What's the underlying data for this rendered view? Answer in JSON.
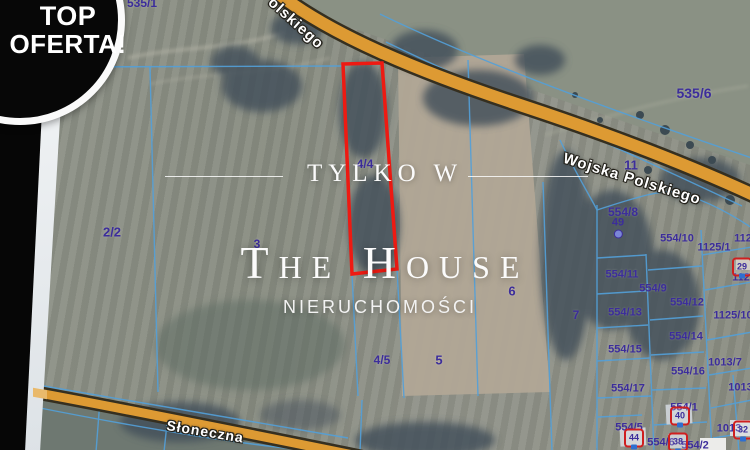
{
  "badge": {
    "line1": "TOP",
    "line2": "OFERTA!"
  },
  "overlay": {
    "tagline": "TYLKO W",
    "brand": "The House",
    "subtitle": "NIERUCHOMOŚCI"
  },
  "roads": {
    "top_label": "olskiego",
    "main_label": "Wojska Polskiego",
    "bottom_label": "Słoneczna"
  },
  "highlight_parcel_label": "4/4",
  "colors": {
    "highlight_red": "#ee1a12",
    "parcel_text": "#3c2d9b",
    "boundary_blue": "#53a0d9",
    "road_fill": "#dd9a33",
    "road_casing": "#352f20",
    "marker_red": "#cf1f1f",
    "badge_bg": "#070707",
    "overlay_text": "#fbfbfb"
  },
  "parcels": [
    {
      "t": "535/1",
      "x": 142,
      "y": 3,
      "s": 12
    },
    {
      "t": "535/6",
      "x": 694,
      "y": 93,
      "s": 14
    },
    {
      "t": "11",
      "x": 631,
      "y": 165,
      "s": 13
    },
    {
      "t": "2/2",
      "x": 112,
      "y": 232,
      "s": 13
    },
    {
      "t": "3",
      "x": 257,
      "y": 244,
      "s": 12
    },
    {
      "t": "4/4",
      "x": 365,
      "y": 164,
      "s": 12
    },
    {
      "t": "4/5",
      "x": 382,
      "y": 360,
      "s": 12
    },
    {
      "t": "5",
      "x": 439,
      "y": 360,
      "s": 13
    },
    {
      "t": "6",
      "x": 512,
      "y": 291,
      "s": 13
    },
    {
      "t": "7",
      "x": 576,
      "y": 315,
      "s": 12
    },
    {
      "t": "554/8",
      "x": 623,
      "y": 212,
      "s": 12
    },
    {
      "t": "554/10",
      "x": 677,
      "y": 239,
      "s": 11
    },
    {
      "t": "1125/1",
      "x": 714,
      "y": 248,
      "s": 11
    },
    {
      "t": "1125",
      "x": 746,
      "y": 239,
      "s": 11
    },
    {
      "t": "1125",
      "x": 744,
      "y": 278,
      "s": 11
    },
    {
      "t": "554/11",
      "x": 622,
      "y": 275,
      "s": 11
    },
    {
      "t": "554/9",
      "x": 653,
      "y": 289,
      "s": 11
    },
    {
      "t": "554/12",
      "x": 687,
      "y": 303,
      "s": 11
    },
    {
      "t": "554/13",
      "x": 625,
      "y": 313,
      "s": 11
    },
    {
      "t": "1125/10",
      "x": 733,
      "y": 316,
      "s": 11
    },
    {
      "t": "554/14",
      "x": 686,
      "y": 337,
      "s": 11
    },
    {
      "t": "554/15",
      "x": 625,
      "y": 350,
      "s": 11
    },
    {
      "t": "1013/7",
      "x": 725,
      "y": 363,
      "s": 11
    },
    {
      "t": "554/16",
      "x": 688,
      "y": 372,
      "s": 11
    },
    {
      "t": "554/17",
      "x": 628,
      "y": 389,
      "s": 11
    },
    {
      "t": "1013/",
      "x": 742,
      "y": 388,
      "s": 11
    },
    {
      "t": "554/1",
      "x": 684,
      "y": 408,
      "s": 11
    },
    {
      "t": "554/5",
      "x": 629,
      "y": 428,
      "s": 11
    },
    {
      "t": "1013",
      "x": 729,
      "y": 429,
      "s": 11
    },
    {
      "t": "554/6",
      "x": 661,
      "y": 443,
      "s": 11
    },
    {
      "t": "554/2",
      "x": 695,
      "y": 446,
      "s": 11
    }
  ],
  "markers": [
    {
      "n": "49",
      "x": 618,
      "y": 228,
      "kind": "point"
    },
    {
      "n": "29",
      "x": 742,
      "y": 267,
      "kind": "house"
    },
    {
      "n": "40",
      "x": 680,
      "y": 416,
      "kind": "house"
    },
    {
      "n": "44",
      "x": 634,
      "y": 438,
      "kind": "house"
    },
    {
      "n": "38",
      "x": 678,
      "y": 442,
      "kind": "house"
    },
    {
      "n": "32",
      "x": 743,
      "y": 430,
      "kind": "house"
    }
  ]
}
